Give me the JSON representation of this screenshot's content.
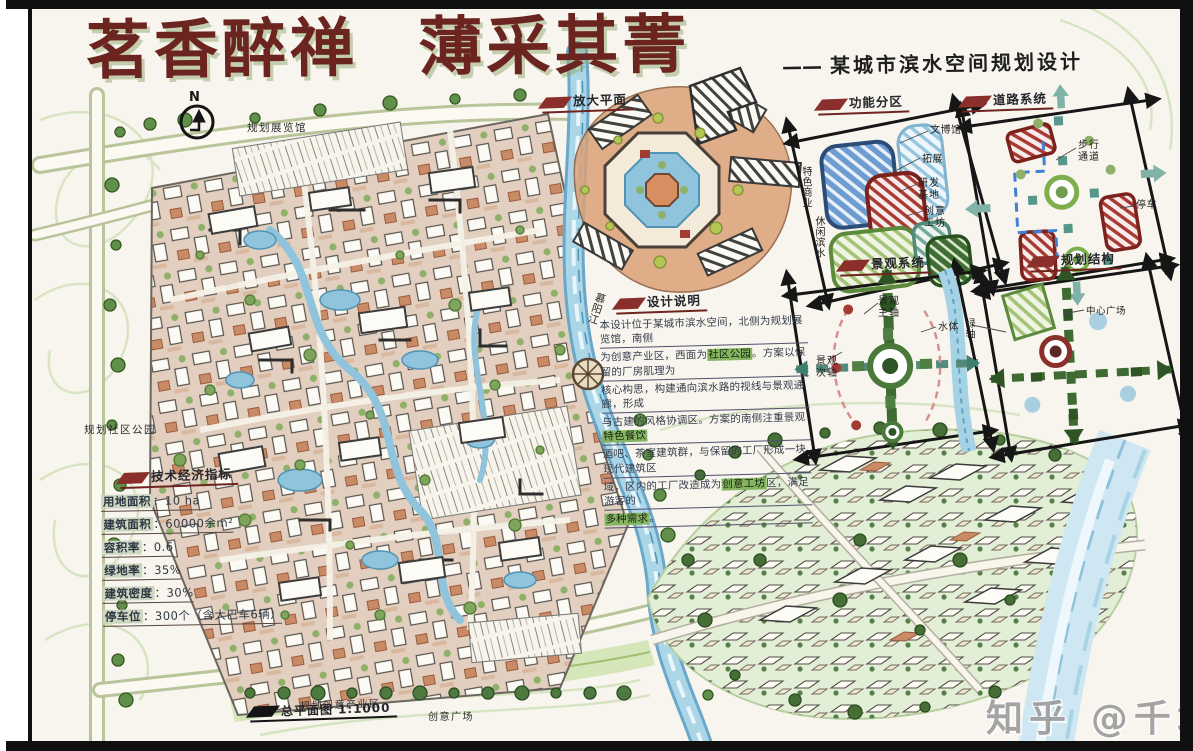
{
  "title": {
    "calligraphy": "茗香醉禅 薄采其菁",
    "dash": "——",
    "subtitle": "某城市滨水空间规划设计"
  },
  "compass": {
    "label": "N"
  },
  "plan": {
    "exhibition_hall": "规划展览馆",
    "community_park": "规划社区公园",
    "creative_district": "规划创意产业区",
    "creative_plaza": "创意广场",
    "river_name": "慕阳江",
    "sheet_name": "总平面图",
    "sheet_scale": "1:1000"
  },
  "enlarged_plan": {
    "label": "放大平面"
  },
  "design_notes": {
    "label": "设计说明",
    "lines": [
      "本设计位于某城市滨水空间，北侧为规划展览馆，南侧",
      "为创意产业区，西面为社区公园。方案以保留的厂房肌理为",
      "核心构思，构建通向滨水路的视线与景观通廊，形成",
      "与古建的风格协调区。方案的南侧注重景观特色餐饮",
      "酒吧、茶室建筑群，与保留的工厂形成一块现代建筑区",
      "域，区内的工厂改造成为创意工坊区，满足游客的",
      "多种需求。"
    ],
    "highlights": [
      "社区公园",
      "特色餐饮",
      "创意工坊",
      "多种需求"
    ]
  },
  "indicators": {
    "label": "技术经济指标",
    "separator": "：",
    "rows": [
      {
        "name": "用地面积",
        "value": "10 ha"
      },
      {
        "name": "建筑面积",
        "value": "60000余m²"
      },
      {
        "name": "容积率",
        "value": "0.6"
      },
      {
        "name": "绿地率",
        "value": "35%"
      },
      {
        "name": "建筑密度",
        "value": "30%"
      },
      {
        "name": "停车位",
        "value": "300个（含大巴车6辆）"
      }
    ]
  },
  "diagrams": [
    {
      "label": "功能分区",
      "annotations": [
        "文博馆",
        "拓展",
        "研发基地",
        "创意工坊",
        "特色商业",
        "休闲滨水"
      ]
    },
    {
      "label": "道路系统",
      "annotations": [
        "步行通道",
        "停车"
      ]
    },
    {
      "label": "景观系统",
      "annotations": [
        "景观主轴",
        "水体",
        "景观次轴"
      ]
    },
    {
      "label": "规划结构",
      "annotations": [
        "中心广场",
        "绿轴"
      ]
    }
  ],
  "frame": {
    "watermark": "知乎 @千城"
  },
  "colors": {
    "title_maroon": "#6b2420",
    "marker_red": "#8a2f2b",
    "ink_blue": "#2e3742",
    "highlight_green": "#86b562",
    "water_blue": "#a6d2e6",
    "tree_green": "#5f8f4a",
    "terracotta": "#cd8663",
    "paper": "#f8f5ee"
  }
}
